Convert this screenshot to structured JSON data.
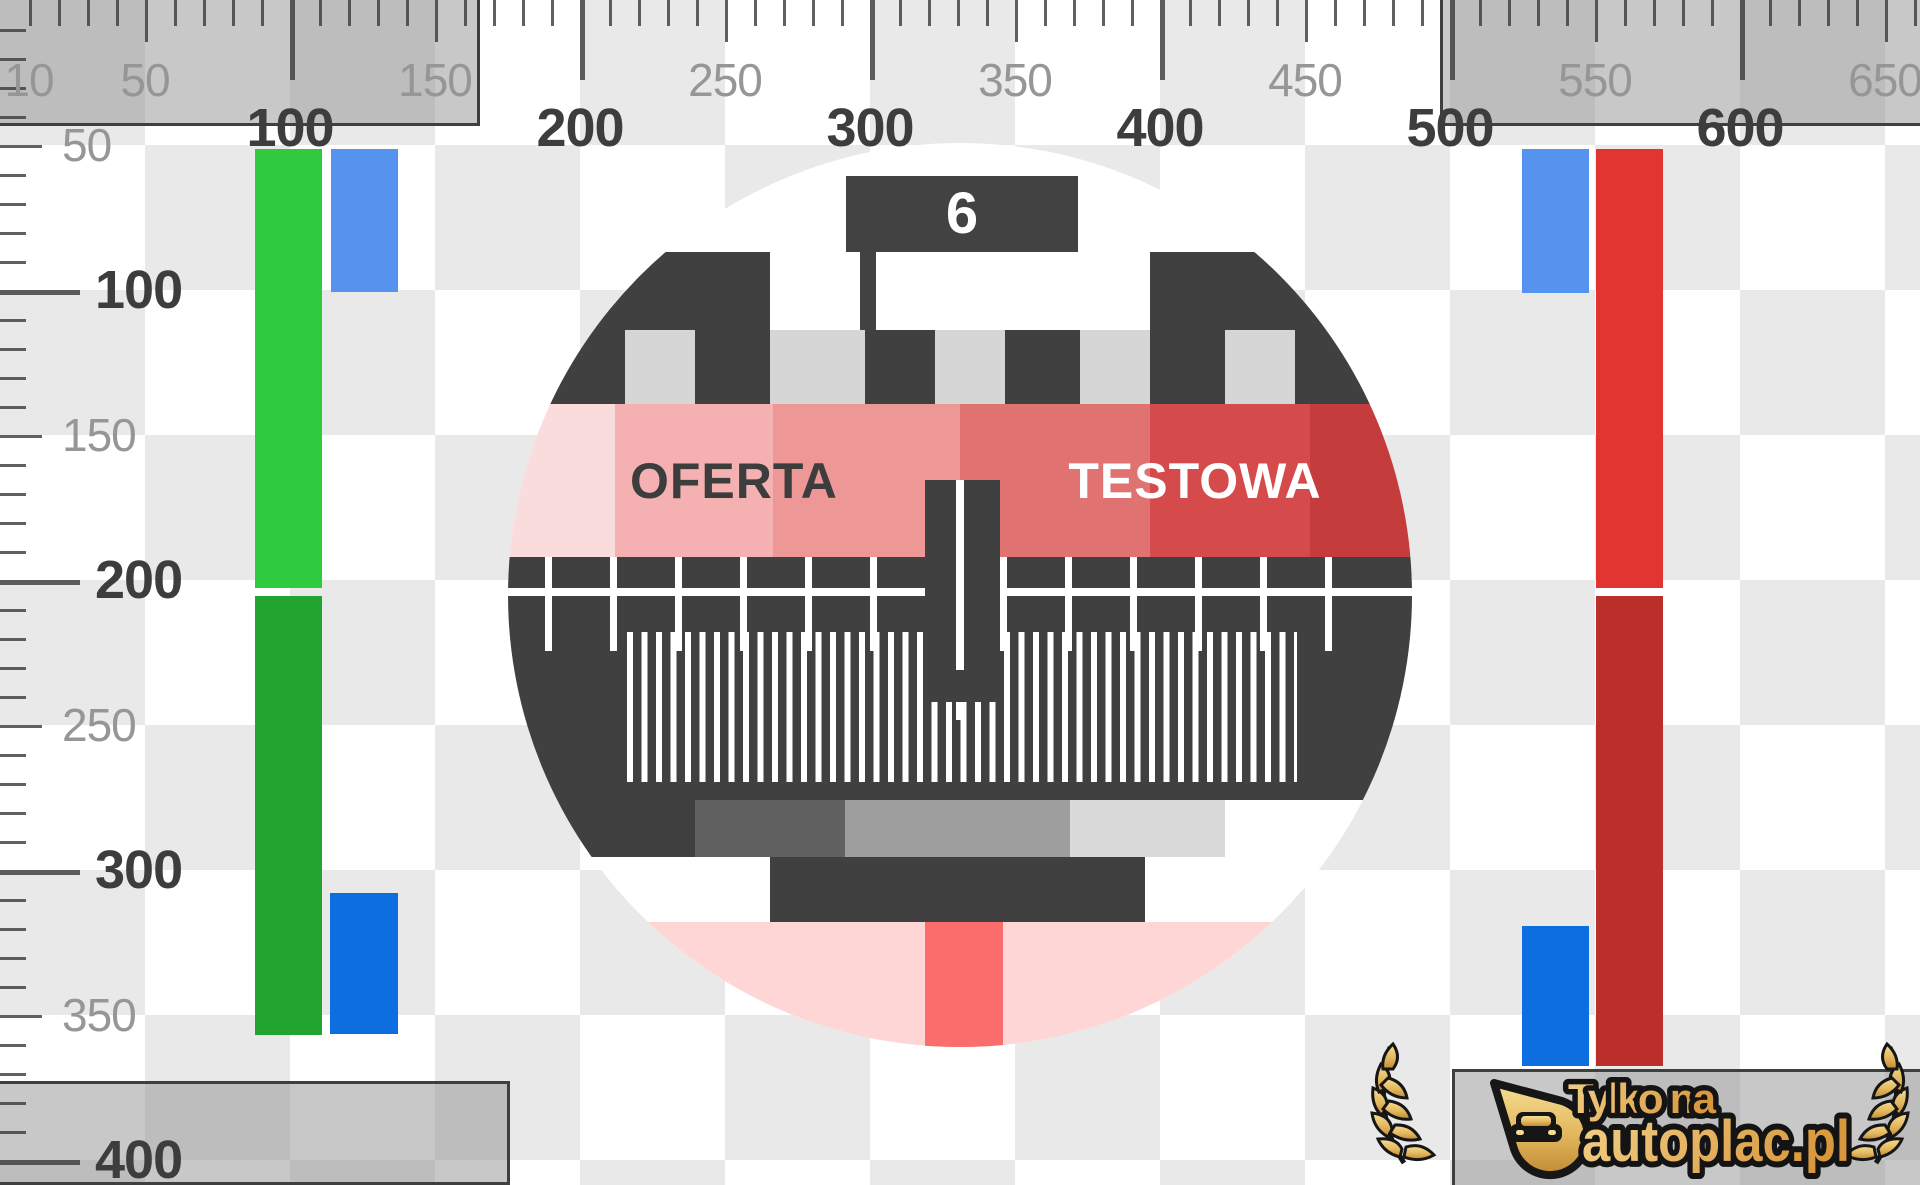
{
  "rulers": {
    "top": {
      "minor_labels": [
        10,
        50,
        150,
        250,
        350,
        450,
        550,
        650
      ],
      "major_labels": [
        100,
        200,
        300,
        400,
        500,
        600
      ]
    },
    "left": {
      "minor_labels": [
        50,
        150,
        250,
        350
      ],
      "major_labels": [
        100,
        200,
        300,
        400
      ]
    }
  },
  "test_card": {
    "channel": "6",
    "band_text_left": "OFERTA",
    "band_text_right": "TESTOWA"
  },
  "logo": {
    "tagline": "Tylko na",
    "brand": "autoplac.pl"
  },
  "colors": {
    "checker_gray": "#e9e9e9",
    "pattern_dark": "#404040",
    "castle_notch_gray": "#d6d6d6",
    "green_top": "#2fca3e",
    "green_bottom": "#22a530",
    "blue_light": "#5593ee",
    "blue_deep": "#0d6fdf",
    "red_top": "#e23431",
    "red_bottom": "#bb2f2a",
    "band_steps": [
      "#fbdcdc",
      "#f5b1b1",
      "#ee9797",
      "#e17272",
      "#d54a4a",
      "#c53c3c"
    ],
    "band_text_left_color": "#3d3d3d",
    "band_text_right_color": "#ffffff",
    "gray_blocks_row": [
      "#404040",
      "#616161",
      "#9e9e9e",
      "#d9d9d9",
      "#ffffff"
    ],
    "bottom_pink": "#ffd6d6",
    "bottom_salmon": "#fb6d6d",
    "logo_gold_light": "#f6dd94",
    "logo_gold_mid": "#e3b85e",
    "logo_gold_dark": "#c08a33"
  }
}
